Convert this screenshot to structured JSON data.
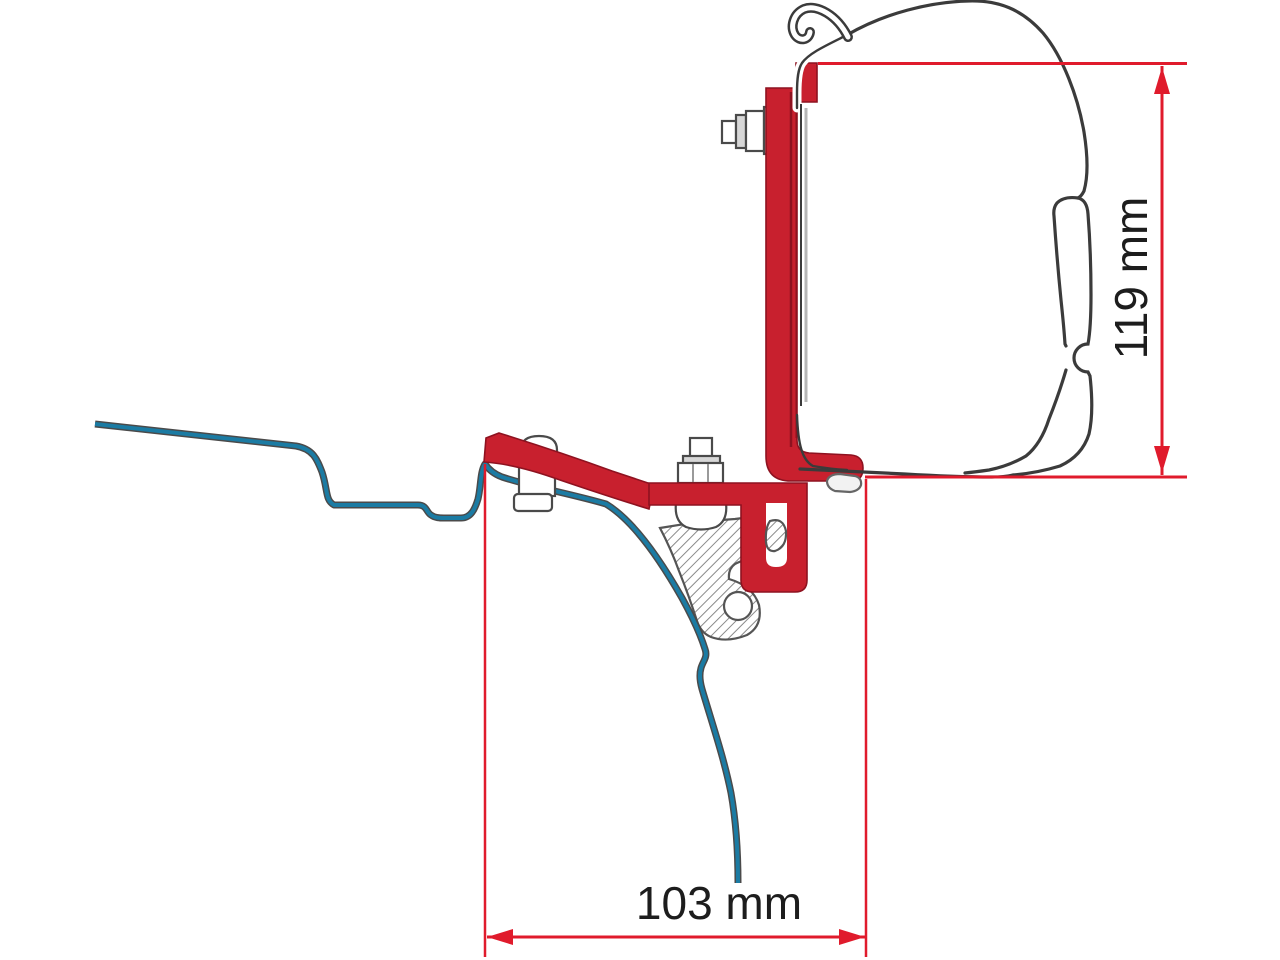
{
  "diagram": {
    "description": "Awning adapter bracket mounting cross-section with van roof profile",
    "dimensions": {
      "vertical": {
        "label": "119 mm"
      },
      "horizontal": {
        "label": "103 mm"
      }
    }
  },
  "colors": {
    "background": "#ffffff",
    "bracket-red": "#c8202e",
    "bracket-red-dark": "#8e1220",
    "dimension-red": "#e01b2c",
    "roof-blue": "#1b7ba3",
    "outline-gray": "#3b3b3b",
    "metal-gray": "#4a4a4a"
  }
}
